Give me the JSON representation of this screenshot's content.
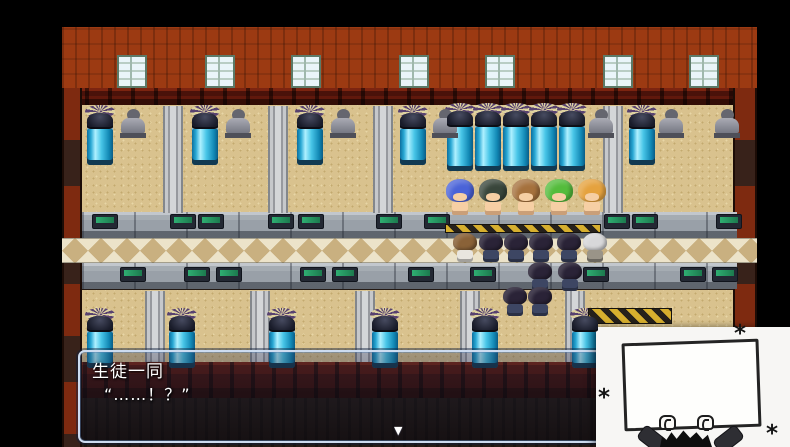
{
  "app": {
    "type": "rpg-game-screenshot",
    "description": "RPG Maker style scene: factory room with vats, statues and rows of students"
  },
  "dialog": {
    "speaker": "生徒一同",
    "text": "“……！？”",
    "continue_indicator": "▼"
  },
  "popup": {
    "asterisk": "*",
    "sign_text": "",
    "description": "hand-drawn figure holding up a blank white sign"
  },
  "palette": {
    "black": "#000000",
    "brick": "#9c3a12",
    "beam": "#43110a",
    "wood-red": "#7e2a10",
    "wood-dark": "#38221a",
    "floor": "#d9c28e",
    "floor-dot": "#c3a96f",
    "stone": "#99a0a8",
    "stone-light": "#c2c7cd",
    "tile-cream": "#ece3c9",
    "tile-tan": "#c9b080",
    "console-green": "#2fae72",
    "hazard-yellow": "#d7af2e",
    "hazard-dark": "#26211b",
    "dialog-border": "#cddcf0",
    "popup-bg": "#f7f6f4",
    "ink": "#1d1d1d",
    "skin": "#f6cfa4",
    "window-glass": "#eaf5f9",
    "window-frame": "#5c7a68"
  },
  "scene": {
    "windows_x": [
      55,
      143,
      229,
      337,
      423,
      541,
      627
    ],
    "upper_pillars_x": [
      101,
      206,
      311,
      541
    ],
    "lower_pillars_x": [
      83,
      188,
      293,
      398,
      503
    ],
    "upper_vats_x": [
      23,
      128,
      233,
      336,
      565
    ],
    "vat_block_x": [
      383,
      411,
      439,
      467,
      495
    ],
    "lower_vats_x": [
      23,
      105,
      205,
      308,
      408,
      508
    ],
    "upper_statues_x": [
      58,
      163,
      268,
      370,
      526,
      596,
      652
    ],
    "upper_consoles_x": [
      30,
      108,
      136,
      206,
      236,
      314,
      362,
      542,
      570,
      654
    ],
    "lower_consoles_x": [
      58,
      122,
      154,
      238,
      270,
      346,
      408,
      521,
      618,
      650
    ],
    "hazard_strips": [
      {
        "x": 383,
        "y": 197,
        "w": 156,
        "h": 9
      },
      {
        "x": 526,
        "y": 281,
        "w": 84,
        "h": 16
      }
    ],
    "front_students": [
      {
        "x": 383,
        "hair": "#4a63d8"
      },
      {
        "x": 416,
        "hair": "#39463b"
      },
      {
        "x": 449,
        "hair": "#a5713d"
      },
      {
        "x": 482,
        "hair": "#54bc3c"
      },
      {
        "x": 515,
        "hair": "#e5a23e"
      }
    ],
    "walkway_row": [
      {
        "x": 390,
        "hair": "#8a6238",
        "body": "#e9e6df"
      },
      {
        "x": 416,
        "hair": "#2a2337",
        "body": "#3d4663"
      },
      {
        "x": 441,
        "hair": "#2a2337",
        "body": "#3d4663"
      },
      {
        "x": 466,
        "hair": "#2a2337",
        "body": "#3d4663"
      },
      {
        "x": 494,
        "hair": "#2a2337",
        "body": "#3d4663"
      },
      {
        "x": 520,
        "hair": "#d8d8da",
        "body": "#9a9488"
      }
    ],
    "back_rows": [
      {
        "x": 465,
        "y": 235,
        "hair": "#2a2337",
        "body": "#3d4663"
      },
      {
        "x": 495,
        "y": 235,
        "hair": "#2a2337",
        "body": "#3d4663"
      },
      {
        "x": 440,
        "y": 260,
        "hair": "#2a2337",
        "body": "#3d4663"
      },
      {
        "x": 465,
        "y": 260,
        "hair": "#2a2337",
        "body": "#3d4663"
      }
    ]
  }
}
